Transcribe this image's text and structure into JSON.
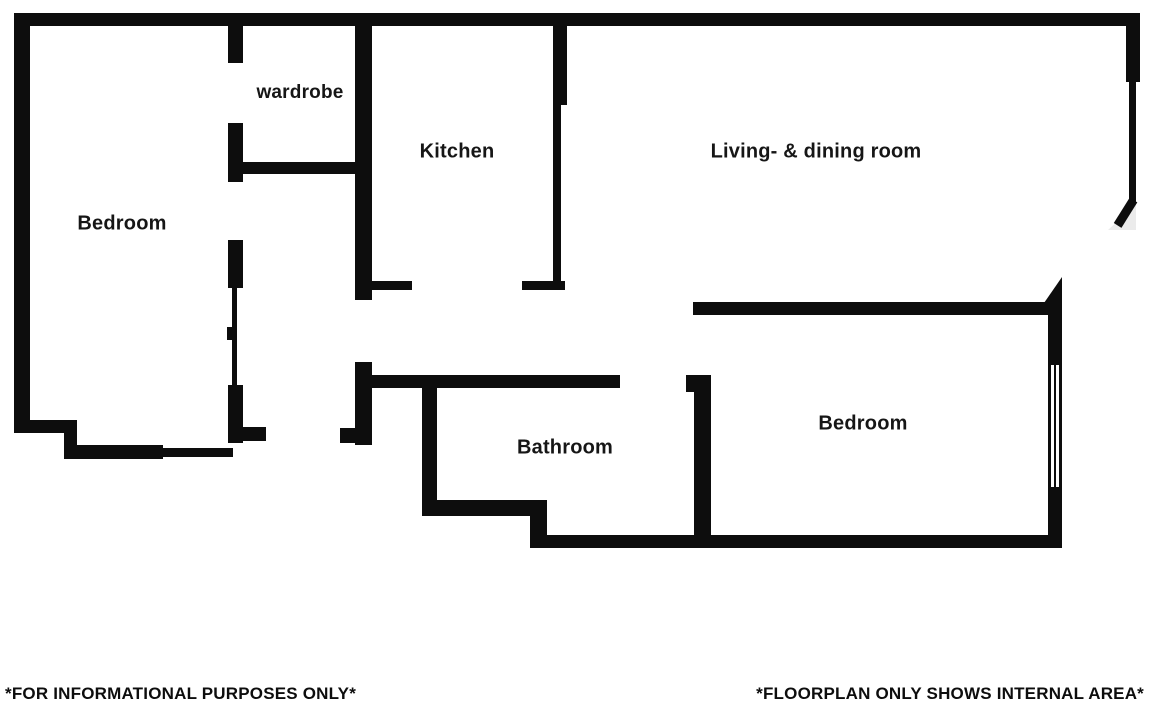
{
  "rooms": {
    "bedroom_left": "Bedroom",
    "wardrobe": "wardrobe",
    "kitchen": "Kitchen",
    "living_dining": "Living- & dining room",
    "bathroom": "Bathroom",
    "bedroom_right": "Bedroom"
  },
  "footer": {
    "left": "*FOR INFORMATIONAL PURPOSES ONLY*",
    "right": "*FLOORPLAN ONLY SHOWS INTERNAL AREA*"
  },
  "colors": {
    "wall": "#0d0d0d",
    "background": "#ffffff",
    "door_swing_shade": "#ebebeb",
    "label_text": "#161616"
  }
}
